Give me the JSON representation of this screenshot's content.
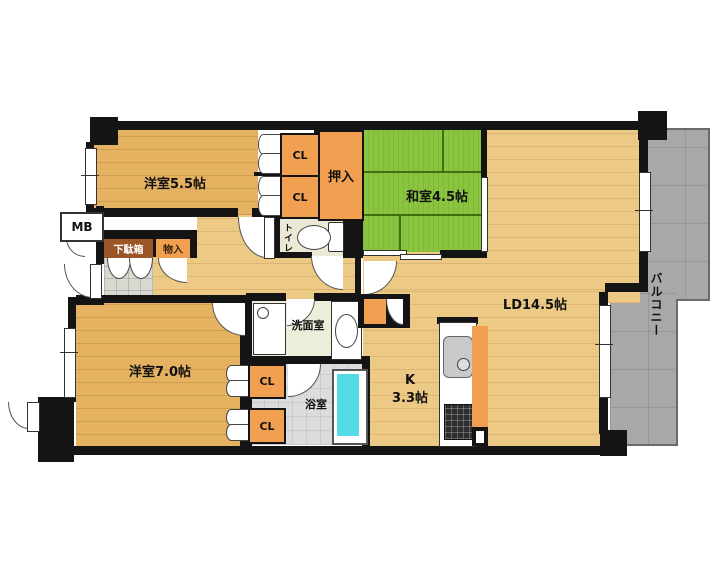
{
  "labels": {
    "yoshitsu55": "洋室5.5帖",
    "washitsu45": "和室4.5帖",
    "ld": "LD14.5帖",
    "kitchen_k": "K",
    "kitchen_size": "3.3帖",
    "yoshitsu70": "洋室7.0帖",
    "senmen": "洗面室",
    "bath": "浴室",
    "toilet": "トイレ",
    "oshiire": "押入",
    "balcony": "バルコニー",
    "mb": "MB",
    "getabako": "下駄箱",
    "monoire": "物入",
    "closet": "CL"
  },
  "colors": {
    "wall": "#141414",
    "wood_room": "#e4b261",
    "wood_ld": "#ecc985",
    "tatami": "#8bc53f",
    "closet_orange": "#f0a050",
    "getabako_bg": "#9c5526",
    "balcony_gray": "#a8a8a8",
    "bathtub": "#55dbe8"
  }
}
